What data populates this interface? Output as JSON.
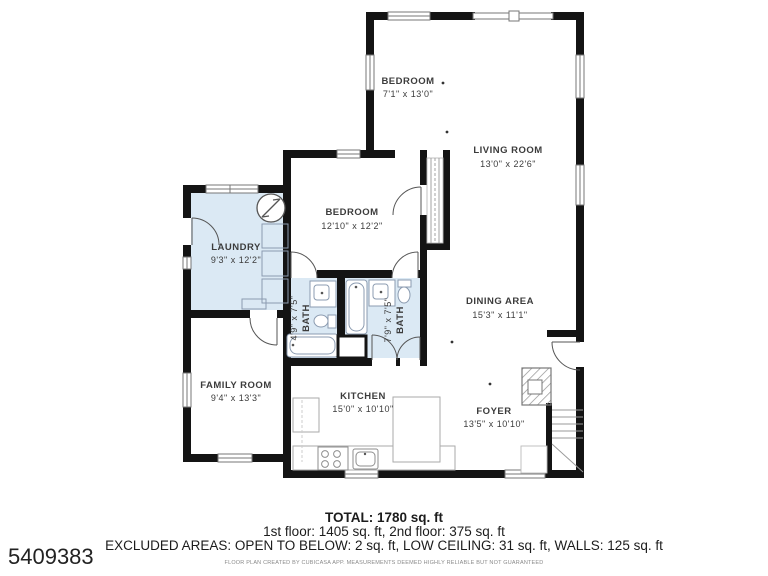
{
  "plan": {
    "rooms": {
      "bedroom_upper": {
        "name": "BEDROOM",
        "dims": "7'1\" x 13'0\""
      },
      "living_room": {
        "name": "LIVING ROOM",
        "dims": "13'0\" x 22'6\""
      },
      "bedroom_main": {
        "name": "BEDROOM",
        "dims": "12'10\" x 12'2\""
      },
      "laundry": {
        "name": "LAUNDRY",
        "dims": "9'3\" x 12'2\""
      },
      "dining_area": {
        "name": "DINING AREA",
        "dims": "15'3\" x 11'1\""
      },
      "bath_small": {
        "name": "BATH",
        "dims": "4'9\" x 7'5\""
      },
      "bath_large": {
        "name": "BATH",
        "dims": "7'9\" x 7'5\""
      },
      "family_room": {
        "name": "FAMILY ROOM",
        "dims": "9'4\" x 13'3\""
      },
      "kitchen": {
        "name": "KITCHEN",
        "dims": "15'0\" x 10'10\""
      },
      "foyer": {
        "name": "FOYER",
        "dims": "13'5\" x 10'10\""
      }
    },
    "summary": {
      "total": "TOTAL: 1780 sq. ft",
      "floors": "1st floor: 1405 sq. ft, 2nd floor: 375 sq. ft",
      "excluded": "EXCLUDED AREAS: OPEN TO BELOW: 2 sq. ft, LOW CEILING: 31 sq. ft, WALLS: 125 sq. ft",
      "disclaimer": "FLOOR PLAN CREATED BY CUBICASA APP. MEASUREMENTS DEEMED HIGHLY RELIABLE BUT NOT GUARANTEED"
    },
    "listing_id": "5409383",
    "colors": {
      "wall": "#141414",
      "wet_area_fill": "#dbe9f4",
      "fixture_line": "#8e8e8e"
    }
  }
}
